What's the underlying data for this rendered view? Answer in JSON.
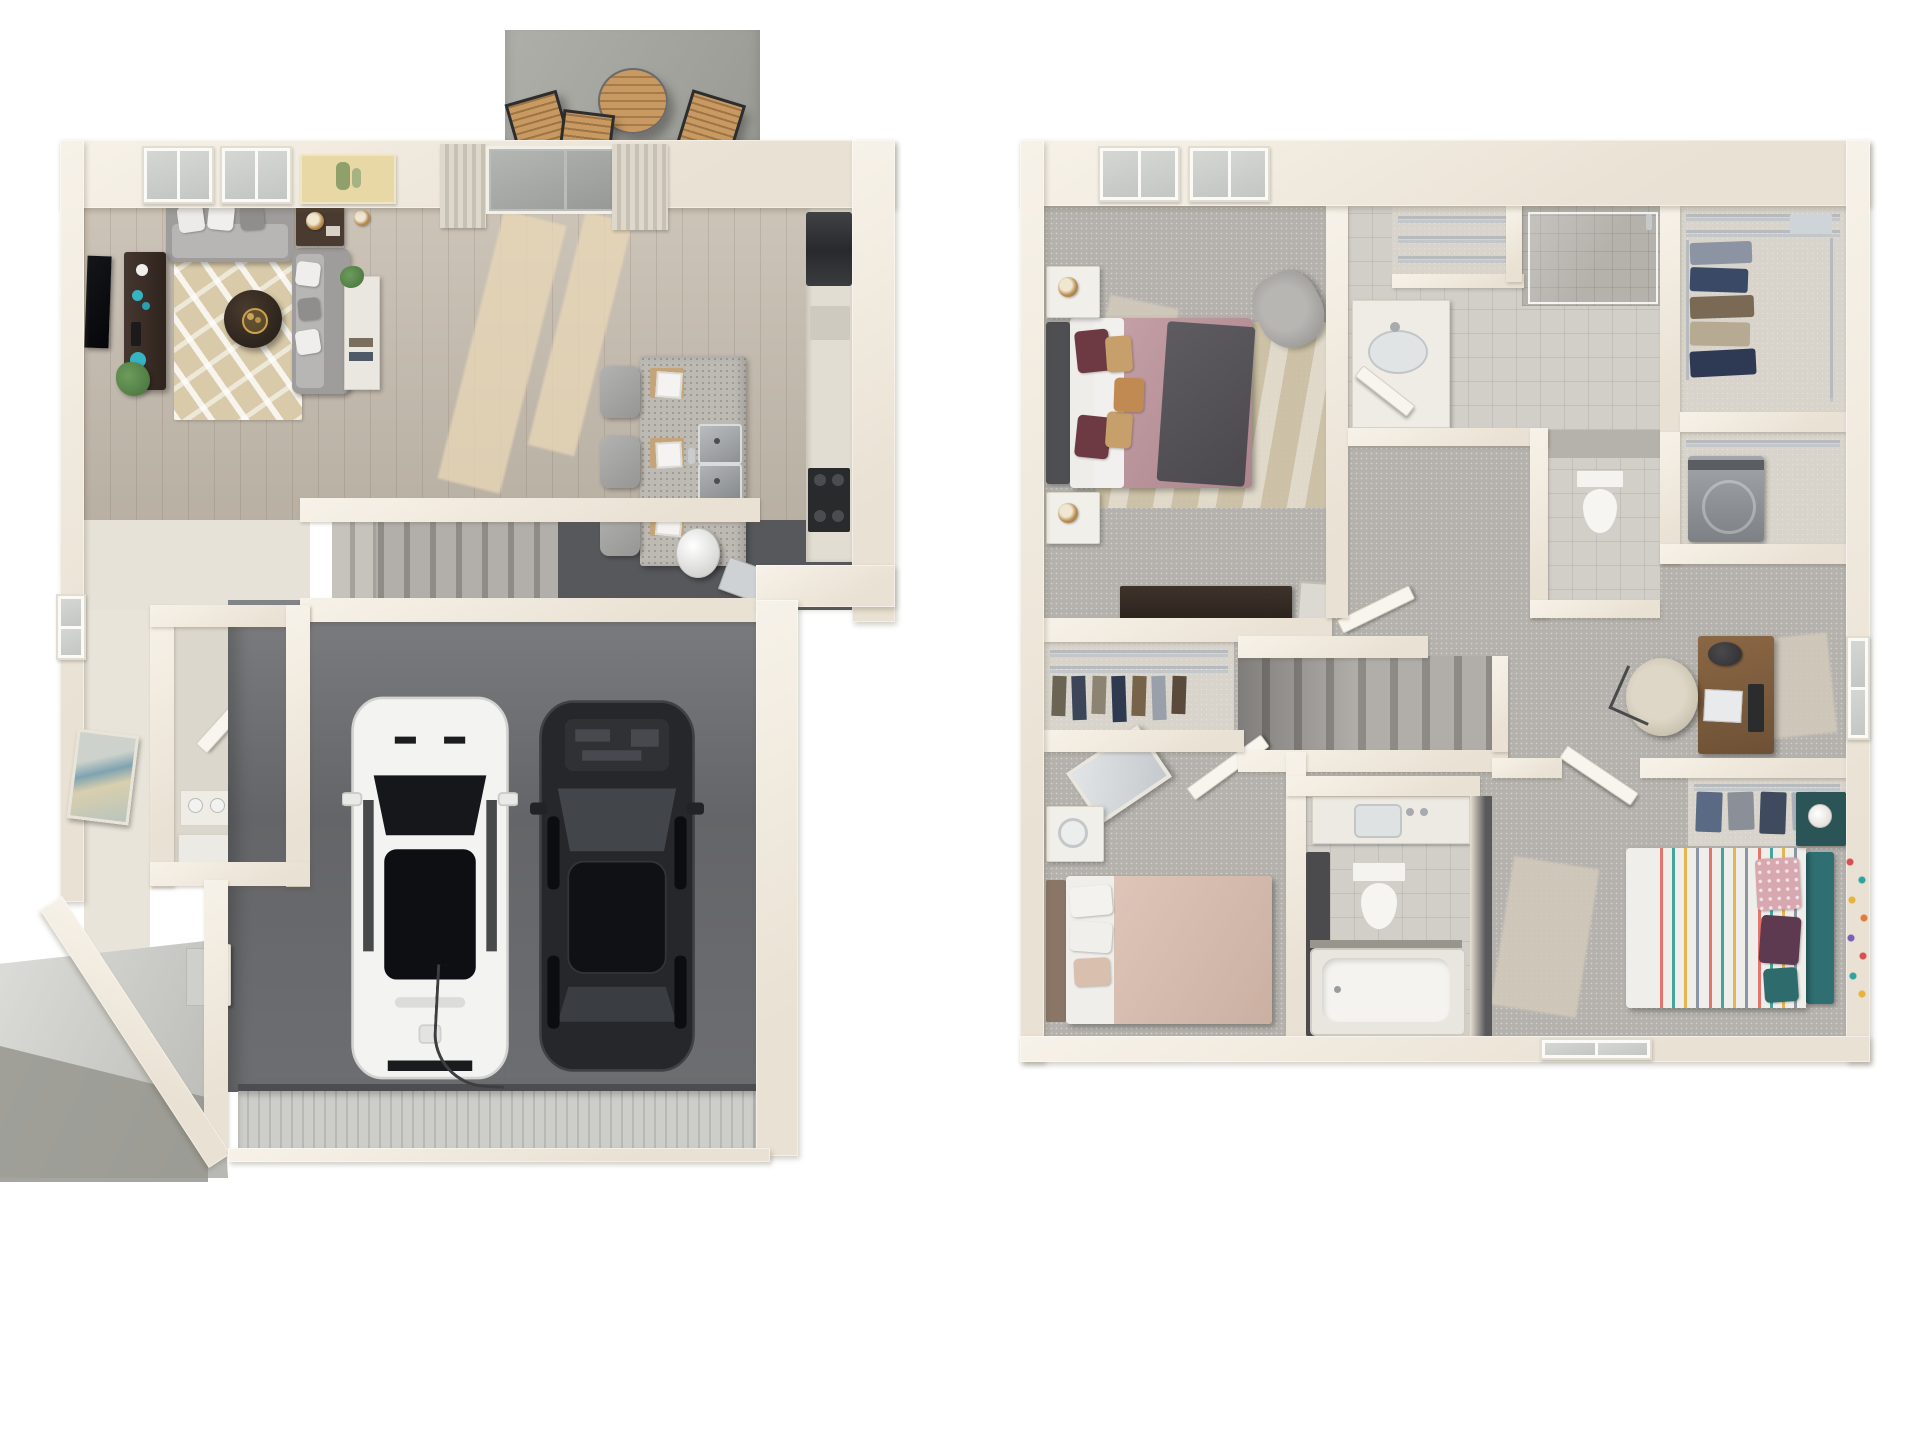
{
  "page": {
    "title": "3D Floor Plan – Two-Story Home",
    "background": "#ffffff"
  },
  "palette": {
    "page_bg": "#ffffff",
    "wall_light": "#f7f2e9",
    "wall_mid": "#e9e1d3",
    "wall_shadow": "#d7cfbf",
    "wood_floor": "#c7bdb0",
    "sunlight": "#ead9b8",
    "carpet": "#b5b2ad",
    "carpet_light": "#d3cabb",
    "closet_floor": "#d8d4cb",
    "stair_carpet": "#a9a6a1",
    "garage_floor": "#6c6d70",
    "garage_door": "#c9c9c6",
    "patio_concrete": "#a5a6a0",
    "tile": "#d2cfc9",
    "tile_dark": "#b5b2ac",
    "sofa_gray": "#9e9d9b",
    "sofa_cushion": "#b7b6b4",
    "rug_beige": "#d9cba9",
    "dark_wood": "#3a2e25",
    "teal_accent": "#35b5c4",
    "bed_mauve": "#bd979d",
    "bed_blush": "#d9c0b2",
    "bed3_teal": "#2f6f72",
    "pillow_maroon": "#6d3942",
    "pillow_tan": "#c79f6a",
    "plant_green": "#5d8c4e",
    "steel": "#9aa0a3",
    "desk_wood": "#8a6744",
    "white_car": "#f3f3f2",
    "black_car": "#26272a",
    "art_yellow": "#e7d8a6"
  },
  "floors": [
    {
      "name": "first-floor",
      "label": "First Floor",
      "rooms": [
        {
          "name": "patio",
          "furniture": [
            "bistro-table",
            "patio-chair",
            "patio-chair",
            "patio-chair"
          ]
        },
        {
          "name": "living-room",
          "furniture": [
            "sofa",
            "chaise-sofa",
            "area-rug",
            "round-coffee-table",
            "tv-console",
            "wall-tv",
            "side-table",
            "bookcase",
            "table-lamp",
            "plant"
          ]
        },
        {
          "name": "kitchen",
          "furniture": [
            "island",
            "bar-stool",
            "bar-stool",
            "bar-stool",
            "place-setting",
            "place-setting",
            "place-setting",
            "double-sink",
            "refrigerator",
            "cooktop",
            "counter",
            "dishwasher"
          ]
        },
        {
          "name": "entry-hall",
          "furniture": [
            "water-heater"
          ]
        },
        {
          "name": "stairs",
          "furniture": [
            "railing"
          ]
        },
        {
          "name": "storage-closet",
          "furniture": [
            "shelf",
            "paint-cans",
            "cabinet",
            "door"
          ]
        },
        {
          "name": "garage",
          "furniture": [
            "white-suv",
            "black-sedan",
            "garage-door"
          ]
        },
        {
          "name": "entry-walk",
          "furniture": [
            "steps",
            "entry-door"
          ]
        }
      ]
    },
    {
      "name": "second-floor",
      "label": "Second Floor",
      "rooms": [
        {
          "name": "master-bedroom",
          "furniture": [
            "bed",
            "nightstand",
            "nightstand",
            "lamp",
            "lamp",
            "accent-chair",
            "dresser",
            "rug",
            "window",
            "window"
          ]
        },
        {
          "name": "master-bathroom",
          "furniture": [
            "vanity",
            "sink",
            "walk-in-shower",
            "linen-closet",
            "door"
          ]
        },
        {
          "name": "walk-in-closet",
          "furniture": [
            "wire-shelves",
            "hanging-clothes"
          ]
        },
        {
          "name": "laundry-closet",
          "furniture": [
            "washer",
            "wire-shelf"
          ]
        },
        {
          "name": "water-closet",
          "furniture": [
            "toilet"
          ]
        },
        {
          "name": "office-nook",
          "furniture": [
            "desk",
            "desk-lamp",
            "laptop",
            "monitor",
            "office-chair",
            "window"
          ]
        },
        {
          "name": "stairs",
          "furniture": []
        },
        {
          "name": "bedroom-2",
          "furniture": [
            "bed",
            "nightstand",
            "leaning-mirror",
            "closet",
            "hanging-clothes",
            "door"
          ]
        },
        {
          "name": "bathroom-2",
          "furniture": [
            "vanity",
            "toilet",
            "bathtub",
            "storage-cabinet"
          ]
        },
        {
          "name": "bedroom-3",
          "furniture": [
            "bed",
            "teal-headboard",
            "striped-duvet",
            "nightstand",
            "lamp",
            "closet",
            "storage-bins",
            "door",
            "confetti-wall-decals",
            "window"
          ]
        }
      ]
    }
  ]
}
